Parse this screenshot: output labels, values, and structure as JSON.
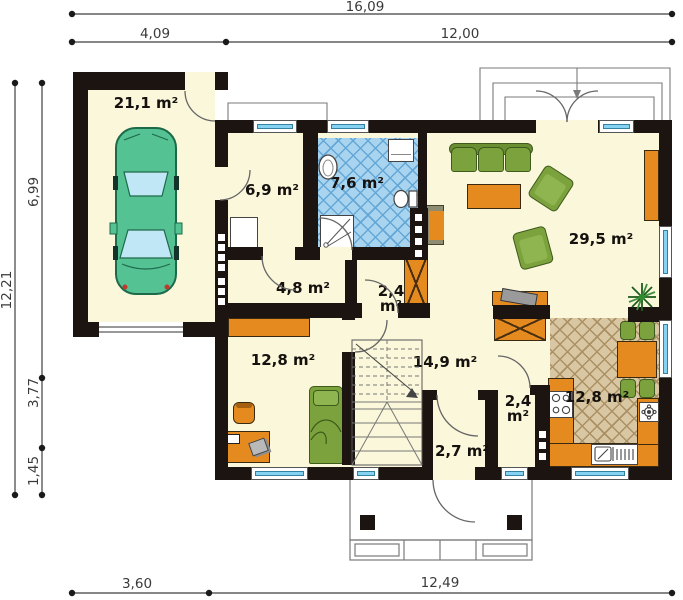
{
  "plan": {
    "title": "house ground floor plan",
    "rooms": {
      "garage": {
        "name": "garage",
        "area": "21,1 m²"
      },
      "utility": {
        "name": "utility",
        "area": "6,9 m²"
      },
      "bathroom": {
        "name": "bathroom",
        "area": "7,6 m²"
      },
      "living": {
        "name": "living room",
        "area": "29,5 m²"
      },
      "hallway": {
        "name": "hallway",
        "area": "4,8 m²"
      },
      "closet": {
        "name": "closet",
        "area": "2,4",
        "unit": "m²"
      },
      "bedroom": {
        "name": "bedroom",
        "area": "12,8 m²"
      },
      "hall": {
        "name": "hall",
        "area": "14,9 m²"
      },
      "wc": {
        "name": "wc",
        "area": "2,4",
        "unit": "m²"
      },
      "vestibule": {
        "name": "vestibule",
        "area": "2,7 m²"
      },
      "kitchen": {
        "name": "kitchen",
        "area": "12,8 m²"
      }
    },
    "dimensions": {
      "top_total": "16,09",
      "top_left": "4,09",
      "top_right": "12,00",
      "left_total": "12,21",
      "left_upper": "6,99",
      "left_middle": "3,77",
      "left_lower": "1,45",
      "bottom_left": "3,60",
      "bottom_right": "12,49"
    },
    "colors": {
      "wall": "#1c1410",
      "floor": "#fbf7da",
      "furniture_orange": "#e58a1f",
      "furniture_green": "#7ca23d",
      "bath_tile": "#a8d4ef",
      "kitchen_tile": "#d8c7a2",
      "window_glass": "#86d2f2",
      "car": "#55c293"
    }
  }
}
